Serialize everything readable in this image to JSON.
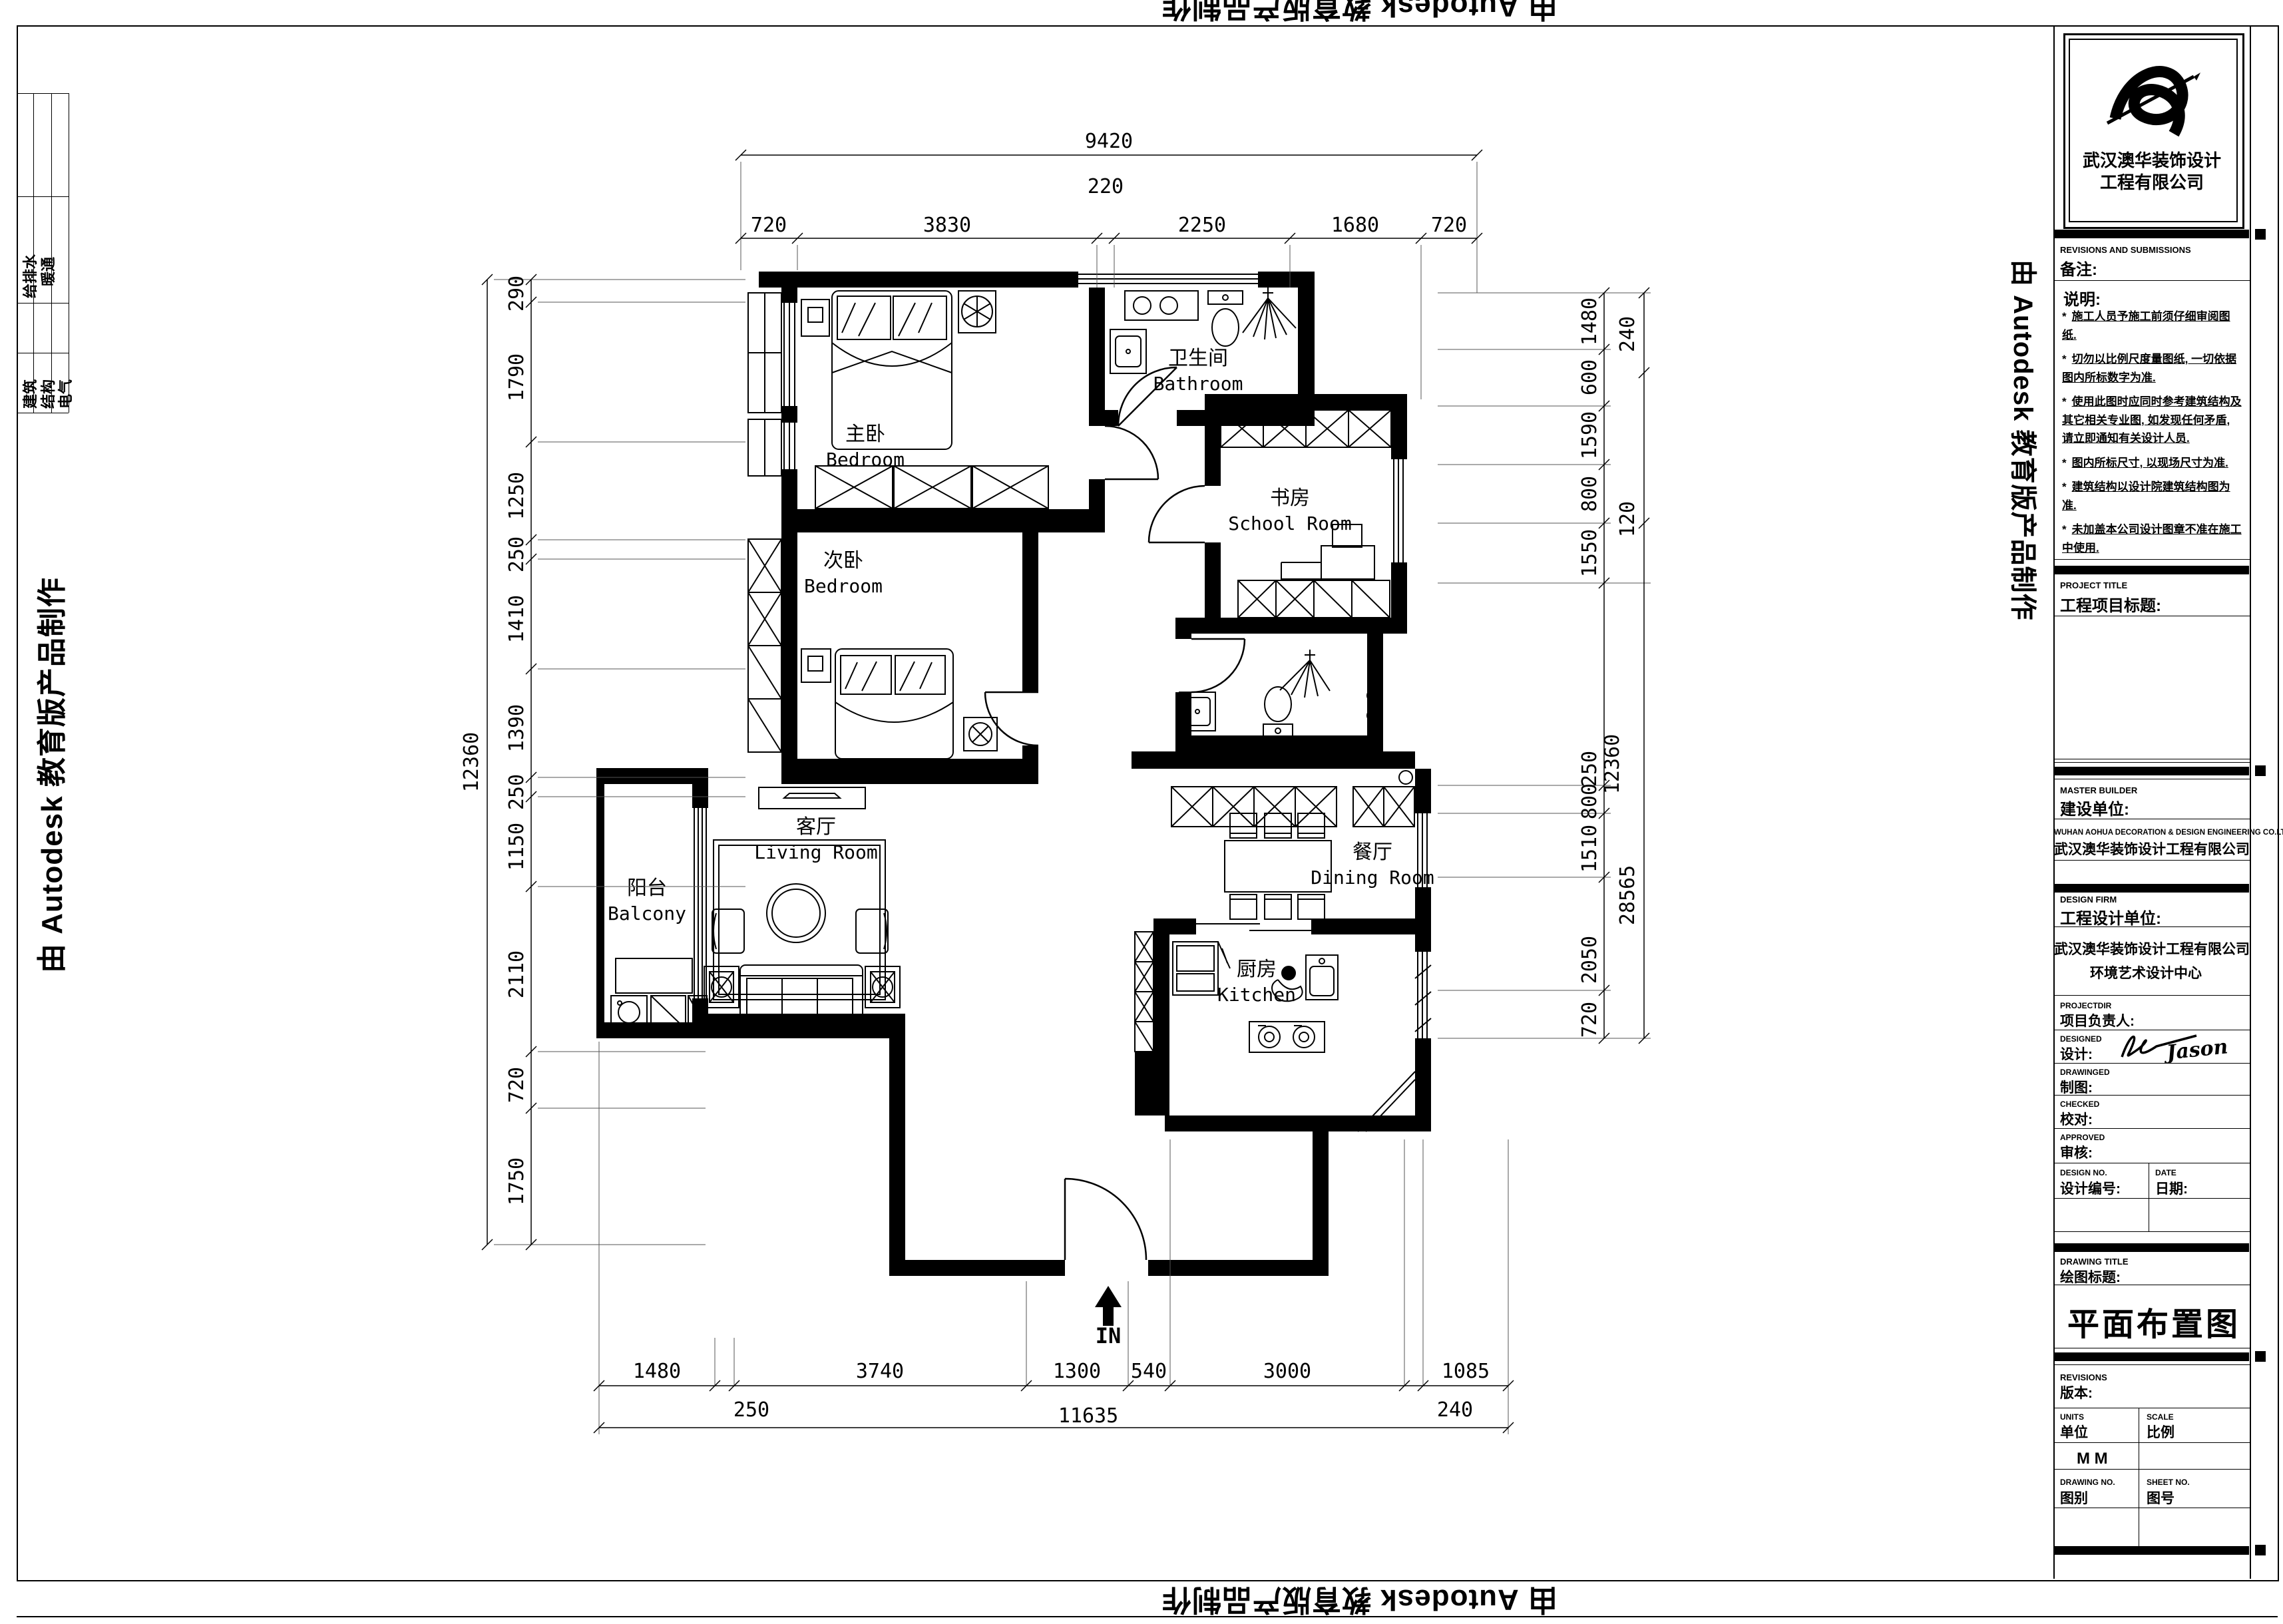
{
  "watermark": {
    "text": "由 Autodesk 教育版产品制作"
  },
  "edge_strip": {
    "labels": [
      "给排水",
      "暖通",
      "建筑",
      "结构",
      "电气"
    ]
  },
  "title_block": {
    "logo_company_line1": "武汉澳华装饰设计",
    "logo_company_line2": "工程有限公司",
    "revisions_en": "REVISIONS AND SUBMISSIONS",
    "revisions_cn": "备注:",
    "notes_title": "说明:",
    "notes": [
      "施工人员予施工前须仔细审阅图纸.",
      "切勿以比例尺度量图纸, 一切依据图内所标数字为准.",
      "使用此图时应同时参考建筑结构及其它相关专业图, 如发现任何矛盾, 请立即通知有关设计人员.",
      "图内所标尺寸, 以现场尺寸为准.",
      "建筑结构以设计院建筑结构图为准.",
      "未加盖本公司设计图章不准在施工中使用."
    ],
    "project_title_en": "PROJECT TITLE",
    "project_title_cn": "工程项目标题:",
    "master_builder_en": "MASTER BUILDER",
    "master_builder_cn": "建设单位:",
    "master_builder_value_en": "WUHAN AOHUA DECORATION & DESIGN ENGINEERING  CO.LTD",
    "master_builder_value_cn": "武汉澳华装饰设计工程有限公司",
    "design_firm_en": "DESIGN FIRM",
    "design_firm_cn": "工程设计单位:",
    "design_firm_value_line1": "武汉澳华装饰设计工程有限公司",
    "design_firm_value_line2": "环境艺术设计中心",
    "projectdir_en": "PROJECTDIR",
    "projectdir_cn": "项目负责人:",
    "designed_en": "DESIGNED",
    "designed_cn": "设计:",
    "designed_signature": "Jason",
    "drawinged_en": "DRAWINGED",
    "drawinged_cn": "制图:",
    "checked_en": "CHECKED",
    "checked_cn": "校对:",
    "approved_en": "APPROVED",
    "approved_cn": "审核:",
    "design_no_en": "DESIGN NO.",
    "design_no_cn": "设计编号:",
    "date_en": "DATE",
    "date_cn": "日期:",
    "drawing_title_en": "DRAWING TITLE",
    "drawing_title_cn": "绘图标题:",
    "drawing_title_value": "平面布置图",
    "revisions2_en": "REVISIONS",
    "revisions2_cn": "版本:",
    "units_en": "UNITS",
    "units_cn": "单位",
    "scale_en": "SCALE",
    "scale_cn": "比例",
    "units_value": "M M",
    "drawing_no_en": "DRAWING NO.",
    "drawing_no_cn": "图别",
    "sheet_no_en": "SHEET NO.",
    "sheet_no_cn": "图号"
  },
  "plan": {
    "rooms": [
      {
        "cn": "主卧",
        "en": "Bedroom"
      },
      {
        "cn": "卫生间",
        "en": "Bathroom"
      },
      {
        "cn": "书房",
        "en": "School Room"
      },
      {
        "cn": "次卧",
        "en": "Bedroom"
      },
      {
        "cn": "客厅",
        "en": "Living Room"
      },
      {
        "cn": "阳台",
        "en": "Balcony"
      },
      {
        "cn": "餐厅",
        "en": "Dining Room"
      },
      {
        "cn": "厨房",
        "en": "Kitchen"
      }
    ],
    "entry_label": "IN",
    "dims": {
      "top_total": "9420",
      "top": [
        "720",
        "3830",
        "220",
        "2250",
        "1680",
        "720"
      ],
      "left_total": "12360",
      "left": [
        "290",
        "1790",
        "1250",
        "250",
        "1410",
        "1390",
        "250",
        "1150",
        "2110",
        "720",
        "1750"
      ],
      "right": [
        "1480",
        "600",
        "1590",
        "800",
        "1550",
        "250",
        "800",
        "1510",
        "2050",
        "720"
      ],
      "right_outer": [
        "240",
        "120",
        "28565"
      ],
      "right_outer_total": "12360",
      "bottom": [
        "1480",
        "250",
        "3740",
        "1300",
        "540",
        "3000",
        "240",
        "1085"
      ],
      "bottom_total": "11635"
    }
  }
}
